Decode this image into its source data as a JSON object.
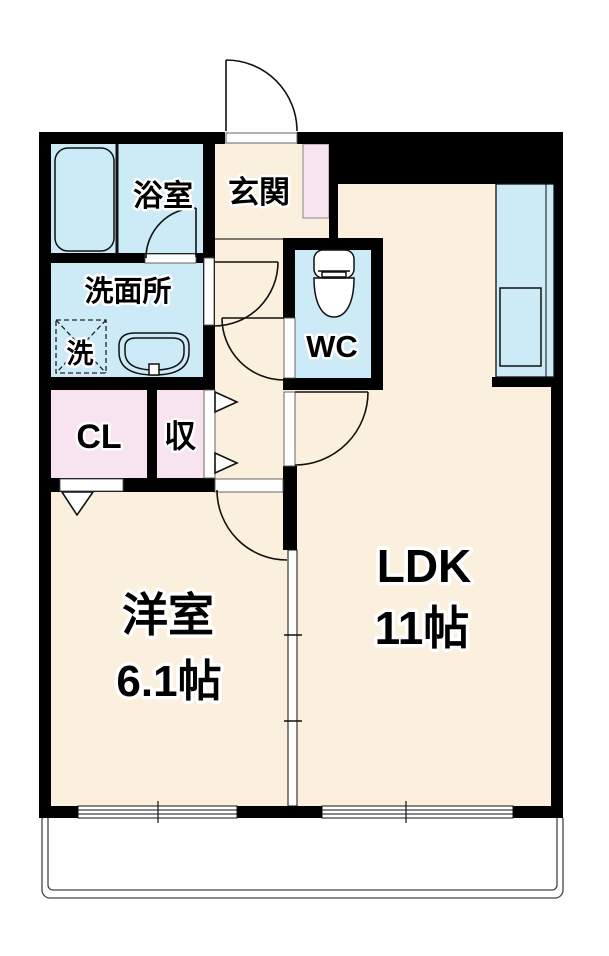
{
  "rooms": {
    "bath": {
      "label": "浴室"
    },
    "entrance": {
      "label": "玄関"
    },
    "washroom": {
      "label": "洗面所"
    },
    "washer": {
      "label": "洗"
    },
    "wc": {
      "label": "WC"
    },
    "closet": {
      "label": "CL"
    },
    "storage": {
      "label": "収"
    },
    "western_room": {
      "label": "洋室",
      "area": "6.1帖"
    },
    "ldk": {
      "label": "LDK",
      "area": "11帖"
    }
  },
  "colors": {
    "wall": "#000000",
    "floor": "#FAF0DD",
    "wet": "#CDEAF7",
    "pink": "#F8E3F0"
  }
}
